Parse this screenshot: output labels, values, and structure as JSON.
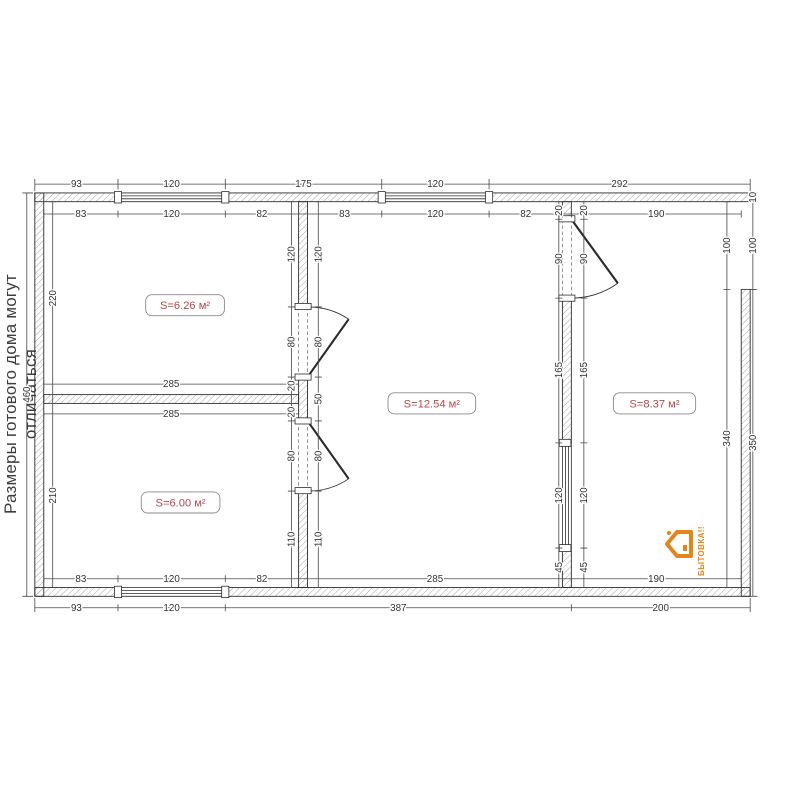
{
  "side_note": "Размеры готового дома могут отличаться",
  "logo": {
    "text": "БЫТОВКА!!",
    "color": "#e2851b",
    "icon": "house-logo-icon"
  },
  "rooms": [
    {
      "area_label": "S=6.26 м²"
    },
    {
      "area_label": "S=6.00 м²"
    },
    {
      "area_label": "S=12.54 м²"
    },
    {
      "area_label": "S=8.37 м²"
    }
  ],
  "colors": {
    "label_red": "#b5484c",
    "line": "#2b2b2b",
    "hatch": "#9a9a9a"
  },
  "dims": {
    "top_outer": [
      "93",
      "120",
      "175",
      "120",
      "292"
    ],
    "top_inner": [
      "83",
      "120",
      "82",
      "83",
      "120",
      "82",
      "190"
    ],
    "bottom_inner": [
      "83",
      "120",
      "82",
      "285",
      "190"
    ],
    "bottom_outer": [
      "93",
      "120",
      "387",
      "200"
    ],
    "left_outer": [
      "460"
    ],
    "left_inner": [
      "220",
      "210"
    ],
    "right_inner": [
      "100",
      "340"
    ],
    "right_outer": [
      "10",
      "100",
      "350"
    ],
    "wall_a_left": [
      "120",
      "80",
      "20",
      "20",
      "80",
      "110"
    ],
    "wall_a_right": [
      "120",
      "80",
      "50",
      "80",
      "110"
    ],
    "wall_b": [
      "285",
      "285"
    ],
    "wall_c_left": [
      "20",
      "90",
      "165",
      "120",
      "45"
    ],
    "wall_c_right": [
      "20",
      "90",
      "165",
      "120",
      "45"
    ]
  }
}
